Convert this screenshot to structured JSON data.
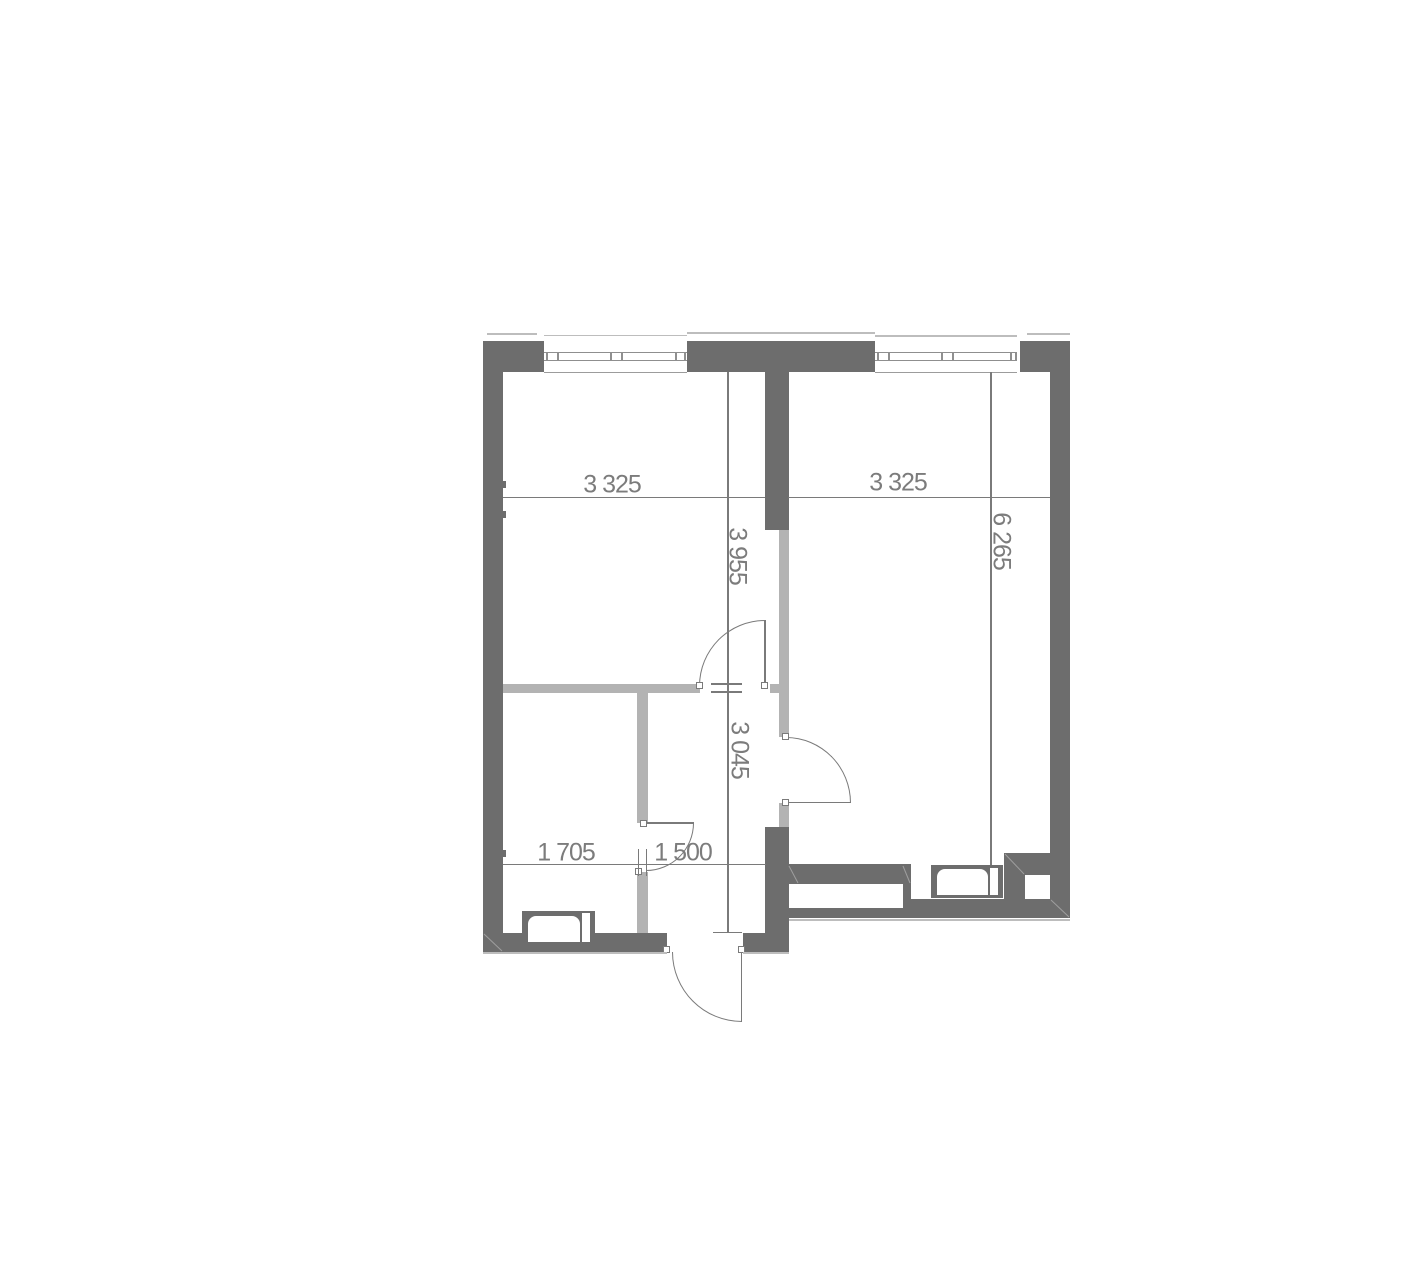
{
  "dimensions": {
    "left_room_width": {
      "label": "3 325"
    },
    "right_room_width": {
      "label": "3 325"
    },
    "left_room_depth": {
      "label": "3 955"
    },
    "right_room_depth": {
      "label": "6 265"
    },
    "hall_depth": {
      "label": "3 045"
    },
    "bottom_room_width": {
      "label": "1 705"
    },
    "hall_width": {
      "label": "1 500"
    }
  },
  "colors": {
    "bg": "#ffffff",
    "wall": "#6d6d6d",
    "part": "#b3b3b3",
    "line": "#7a7a7a",
    "text": "#7c7c7c",
    "frame": "#8f8f8f",
    "sill": "#9c9c9c",
    "outline": "#bdbdbd",
    "seam": "#9e9e9e"
  }
}
